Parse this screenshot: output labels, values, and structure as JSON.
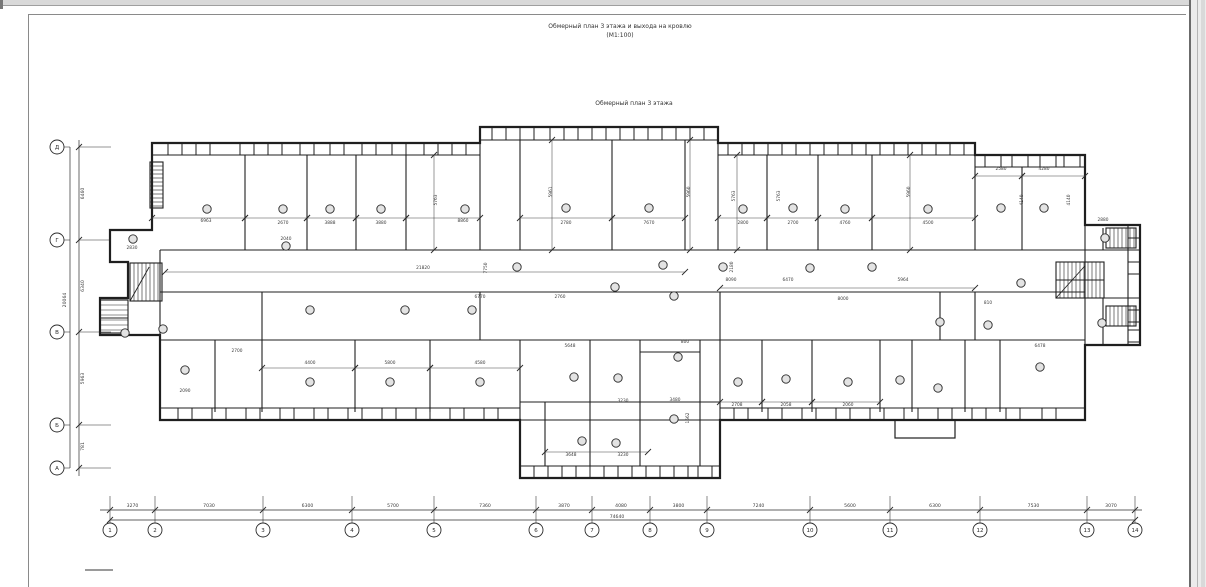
{
  "window": {
    "title_line1": "Обмерный план 3 этажа и выхода на кровлю",
    "title_line2": "(М1:100)",
    "subtitle": "Обмерный план 3 этажа"
  },
  "colors": {
    "ink": "#1f1f1f",
    "thin": "#333333",
    "dim_text": "#3a3a3a",
    "axis": "#2b2b2b"
  },
  "axes_bottom": {
    "y_chain": 510,
    "y_total": 520,
    "y_circle": 530,
    "r": 7,
    "line_x1": 100,
    "line_x2": 1142,
    "total": "74640",
    "total_x": 617,
    "nodes": [
      {
        "n": "1",
        "x": 110
      },
      {
        "n": "2",
        "x": 155
      },
      {
        "n": "3",
        "x": 263
      },
      {
        "n": "4",
        "x": 352
      },
      {
        "n": "5",
        "x": 434
      },
      {
        "n": "6",
        "x": 536
      },
      {
        "n": "7",
        "x": 592
      },
      {
        "n": "8",
        "x": 650
      },
      {
        "n": "9",
        "x": 707
      },
      {
        "n": "10",
        "x": 810
      },
      {
        "n": "11",
        "x": 890
      },
      {
        "n": "12",
        "x": 980
      },
      {
        "n": "13",
        "x": 1087
      },
      {
        "n": "14",
        "x": 1135
      }
    ],
    "spans": [
      "3270",
      "7030",
      "6300",
      "5700",
      "7360",
      "3870",
      "4080",
      "3800",
      "7240",
      "5600",
      "6300",
      "7530",
      "3070"
    ]
  },
  "axes_left": {
    "x_chain": 79,
    "x_total": 70,
    "x_circle": 57,
    "r": 7,
    "line_y1": 140,
    "line_y2": 476,
    "total": "20064",
    "total_y": 300,
    "nodes": [
      {
        "n": "Д",
        "y": 147
      },
      {
        "n": "Г",
        "y": 240
      },
      {
        "n": "В",
        "y": 332
      },
      {
        "n": "Б",
        "y": 425
      },
      {
        "n": "А",
        "y": 468
      }
    ],
    "spans": [
      "6460",
      "6340",
      "5963",
      "781"
    ]
  },
  "plan": {
    "outline": "152,143 480,143 480,127 718,127 718,143 975,143 975,155 1085,155 1085,225 1140,225 1140,345 1085,345 1085,420 720,420 720,478 520,478 520,420 160,420 160,335 100,335 100,298 128,298 128,262 110,262 110,230 152,230",
    "bands": [
      {
        "o": "h",
        "e1": 143,
        "e2": 155,
        "a1": 152,
        "a2": 480,
        "wins": [
          [
            168,
            14
          ],
          [
            196,
            14
          ],
          [
            240,
            14
          ],
          [
            268,
            14
          ],
          [
            300,
            14
          ],
          [
            330,
            14
          ],
          [
            362,
            14
          ],
          [
            392,
            14
          ],
          [
            424,
            14
          ],
          [
            452,
            14
          ]
        ]
      },
      {
        "o": "h",
        "e1": 127,
        "e2": 140,
        "a1": 480,
        "a2": 718,
        "wins": [
          [
            492,
            14
          ],
          [
            520,
            14
          ],
          [
            550,
            14
          ],
          [
            578,
            14
          ],
          [
            606,
            14
          ],
          [
            634,
            14
          ],
          [
            662,
            14
          ],
          [
            690,
            14
          ]
        ]
      },
      {
        "o": "h",
        "e1": 143,
        "e2": 155,
        "a1": 718,
        "a2": 975,
        "wins": [
          [
            728,
            14
          ],
          [
            754,
            14
          ],
          [
            782,
            14
          ],
          [
            810,
            14
          ],
          [
            838,
            14
          ],
          [
            866,
            14
          ],
          [
            894,
            14
          ],
          [
            922,
            14
          ],
          [
            950,
            14
          ]
        ]
      },
      {
        "o": "h",
        "e1": 155,
        "e2": 167,
        "a1": 975,
        "a2": 1085,
        "wins": [
          [
            985,
            16
          ],
          [
            1012,
            16
          ],
          [
            1040,
            16
          ],
          [
            1064,
            16
          ]
        ]
      },
      {
        "o": "h",
        "e1": 420,
        "e2": 408,
        "a1": 160,
        "a2": 520,
        "wins": [
          [
            178,
            14
          ],
          [
            212,
            14
          ],
          [
            246,
            14
          ],
          [
            280,
            14
          ],
          [
            314,
            14
          ],
          [
            348,
            14
          ],
          [
            382,
            14
          ],
          [
            416,
            14
          ],
          [
            450,
            14
          ],
          [
            484,
            14
          ]
        ]
      },
      {
        "o": "h",
        "e1": 478,
        "e2": 466,
        "a1": 520,
        "a2": 720,
        "wins": [
          [
            534,
            14
          ],
          [
            562,
            14
          ],
          [
            590,
            14
          ],
          [
            618,
            14
          ],
          [
            646,
            14
          ],
          [
            674,
            14
          ],
          [
            698,
            14
          ]
        ]
      },
      {
        "o": "h",
        "e1": 420,
        "e2": 408,
        "a1": 720,
        "a2": 1085,
        "wins": [
          [
            734,
            14
          ],
          [
            768,
            14
          ],
          [
            802,
            14
          ],
          [
            836,
            14
          ],
          [
            870,
            14
          ],
          [
            904,
            14
          ],
          [
            938,
            14
          ],
          [
            972,
            14
          ],
          [
            1006,
            14
          ],
          [
            1042,
            14
          ]
        ]
      },
      {
        "o": "v",
        "e1": 1140,
        "e2": 1128,
        "a1": 225,
        "a2": 345,
        "wins": [
          [
            238,
            12
          ],
          [
            262,
            12
          ],
          [
            310,
            12
          ],
          [
            330,
            12
          ]
        ]
      }
    ],
    "walls": [
      [
        160,
        250,
        1085,
        250
      ],
      [
        160,
        292,
        1085,
        292
      ],
      [
        160,
        340,
        1085,
        340
      ],
      [
        520,
        402,
        720,
        402
      ],
      [
        520,
        420,
        720,
        420
      ],
      [
        1085,
        250,
        1140,
        250
      ],
      [
        1085,
        298,
        1140,
        298
      ],
      [
        1056,
        280,
        1104,
        280
      ],
      [
        640,
        352,
        700,
        352
      ],
      [
        100,
        318,
        128,
        318
      ],
      [
        245,
        155,
        245,
        250
      ],
      [
        307,
        155,
        307,
        250
      ],
      [
        356,
        155,
        356,
        250
      ],
      [
        406,
        155,
        406,
        250
      ],
      [
        480,
        143,
        480,
        250
      ],
      [
        520,
        140,
        520,
        250
      ],
      [
        612,
        140,
        612,
        250
      ],
      [
        685,
        140,
        685,
        250
      ],
      [
        718,
        143,
        718,
        250
      ],
      [
        767,
        155,
        767,
        250
      ],
      [
        818,
        155,
        818,
        250
      ],
      [
        872,
        155,
        872,
        250
      ],
      [
        975,
        155,
        975,
        250
      ],
      [
        1022,
        167,
        1022,
        250
      ],
      [
        160,
        250,
        160,
        335
      ],
      [
        262,
        292,
        262,
        340
      ],
      [
        480,
        292,
        480,
        340
      ],
      [
        720,
        292,
        720,
        340
      ],
      [
        940,
        292,
        940,
        340
      ],
      [
        975,
        292,
        975,
        340
      ],
      [
        215,
        340,
        215,
        412
      ],
      [
        262,
        340,
        262,
        412
      ],
      [
        355,
        340,
        355,
        412
      ],
      [
        430,
        340,
        430,
        412
      ],
      [
        520,
        340,
        520,
        420
      ],
      [
        590,
        340,
        590,
        466
      ],
      [
        640,
        340,
        640,
        466
      ],
      [
        700,
        340,
        700,
        466
      ],
      [
        545,
        402,
        545,
        466
      ],
      [
        720,
        340,
        720,
        420
      ],
      [
        762,
        340,
        762,
        412
      ],
      [
        812,
        340,
        812,
        412
      ],
      [
        880,
        340,
        880,
        412
      ],
      [
        912,
        340,
        912,
        412
      ],
      [
        965,
        340,
        965,
        412
      ],
      [
        1000,
        340,
        1000,
        412
      ],
      [
        1103,
        228,
        1103,
        250
      ],
      [
        1103,
        298,
        1103,
        345
      ],
      [
        1085,
        225,
        1085,
        345
      ]
    ],
    "wallrects": [
      [
        895,
        420,
        60,
        18
      ]
    ],
    "dimlines": [
      [
        152,
        218,
        245,
        218
      ],
      [
        245,
        218,
        307,
        218
      ],
      [
        307,
        218,
        356,
        218
      ],
      [
        356,
        218,
        406,
        218
      ],
      [
        406,
        218,
        480,
        218
      ],
      [
        520,
        218,
        612,
        218
      ],
      [
        612,
        218,
        685,
        218
      ],
      [
        718,
        218,
        767,
        218
      ],
      [
        767,
        218,
        818,
        218
      ],
      [
        818,
        218,
        872,
        218
      ],
      [
        872,
        218,
        975,
        218
      ],
      [
        975,
        176,
        1022,
        176
      ],
      [
        1022,
        176,
        1085,
        176
      ],
      [
        434,
        155,
        434,
        250
      ],
      [
        552,
        140,
        552,
        250
      ],
      [
        690,
        140,
        690,
        250
      ],
      [
        737,
        155,
        737,
        250
      ],
      [
        910,
        155,
        910,
        250
      ],
      [
        165,
        272,
        685,
        272
      ],
      [
        720,
        288,
        975,
        288
      ],
      [
        262,
        368,
        355,
        368
      ],
      [
        355,
        368,
        430,
        368
      ],
      [
        430,
        368,
        520,
        368
      ],
      [
        545,
        452,
        648,
        452
      ],
      [
        720,
        402,
        762,
        402
      ],
      [
        762,
        402,
        812,
        402
      ],
      [
        812,
        402,
        880,
        402
      ]
    ],
    "stairs": [
      {
        "x": 130,
        "y": 263,
        "w": 32,
        "h": 38,
        "o": "v",
        "s": 4,
        "d": 1
      },
      {
        "x": 1056,
        "y": 262,
        "w": 48,
        "h": 36,
        "o": "v",
        "s": 4,
        "d": 1
      },
      {
        "x": 150,
        "y": 162,
        "w": 13,
        "h": 46,
        "o": "h",
        "s": 4,
        "d": 0
      },
      {
        "x": 100,
        "y": 300,
        "w": 28,
        "h": 33,
        "o": "h",
        "s": 5,
        "d": 0
      },
      {
        "x": 1106,
        "y": 228,
        "w": 30,
        "h": 20,
        "o": "v",
        "s": 4,
        "d": 0
      },
      {
        "x": 1106,
        "y": 306,
        "w": 30,
        "h": 20,
        "o": "v",
        "s": 4,
        "d": 0
      }
    ],
    "rooms": [
      [
        207,
        209
      ],
      [
        283,
        209
      ],
      [
        330,
        209
      ],
      [
        381,
        209
      ],
      [
        465,
        209
      ],
      [
        566,
        208
      ],
      [
        649,
        208
      ],
      [
        743,
        209
      ],
      [
        793,
        208
      ],
      [
        845,
        209
      ],
      [
        928,
        209
      ],
      [
        1001,
        208
      ],
      [
        1044,
        208
      ],
      [
        133,
        239
      ],
      [
        286,
        246
      ],
      [
        517,
        267
      ],
      [
        615,
        287
      ],
      [
        663,
        265
      ],
      [
        674,
        296
      ],
      [
        723,
        267
      ],
      [
        810,
        268
      ],
      [
        872,
        267
      ],
      [
        310,
        310
      ],
      [
        405,
        310
      ],
      [
        472,
        310
      ],
      [
        940,
        322
      ],
      [
        988,
        325
      ],
      [
        1021,
        283
      ],
      [
        1105,
        238
      ],
      [
        1102,
        323
      ],
      [
        125,
        333
      ],
      [
        163,
        329
      ],
      [
        185,
        370
      ],
      [
        310,
        382
      ],
      [
        390,
        382
      ],
      [
        480,
        382
      ],
      [
        574,
        377
      ],
      [
        618,
        378
      ],
      [
        678,
        357
      ],
      [
        582,
        441
      ],
      [
        616,
        443
      ],
      [
        674,
        419
      ],
      [
        738,
        382
      ],
      [
        786,
        379
      ],
      [
        848,
        382
      ],
      [
        900,
        380
      ],
      [
        938,
        388
      ],
      [
        1040,
        367
      ]
    ],
    "dims": [
      [
        "6963",
        206,
        222,
        0
      ],
      [
        "2670",
        283,
        224,
        0
      ],
      [
        "3888",
        330,
        224,
        0
      ],
      [
        "3880",
        381,
        224,
        0
      ],
      [
        "8860",
        463,
        222,
        0
      ],
      [
        "2780",
        566,
        224,
        0
      ],
      [
        "7670",
        649,
        224,
        0
      ],
      [
        "2800",
        743,
        224,
        0
      ],
      [
        "2700",
        793,
        224,
        0
      ],
      [
        "4760",
        845,
        224,
        0
      ],
      [
        "4500",
        928,
        224,
        0
      ],
      [
        "2580",
        1001,
        170,
        0
      ],
      [
        "4280",
        1044,
        170,
        0
      ],
      [
        "5763",
        437,
        200,
        1
      ],
      [
        "5961",
        552,
        192,
        1
      ],
      [
        "5960",
        690,
        192,
        1
      ],
      [
        "5763",
        735,
        196,
        1
      ],
      [
        "5763",
        780,
        196,
        1
      ],
      [
        "5960",
        910,
        192,
        1
      ],
      [
        "4140",
        1023,
        200,
        1
      ],
      [
        "4140",
        1070,
        200,
        1
      ],
      [
        "2830",
        132,
        249,
        0
      ],
      [
        "2040",
        286,
        240,
        0
      ],
      [
        "21820",
        423,
        269,
        0
      ],
      [
        "7750",
        487,
        268,
        1
      ],
      [
        "6770",
        480,
        298,
        0
      ],
      [
        "2760",
        560,
        298,
        0
      ],
      [
        "2180",
        733,
        267,
        1
      ],
      [
        "8090",
        731,
        281,
        0
      ],
      [
        "6470",
        788,
        281,
        0
      ],
      [
        "5964",
        903,
        281,
        0
      ],
      [
        "8000",
        843,
        300,
        0
      ],
      [
        "5648",
        570,
        347,
        0
      ],
      [
        "800",
        685,
        343,
        0
      ],
      [
        "3230",
        623,
        402,
        0
      ],
      [
        "3480",
        675,
        401,
        0
      ],
      [
        "3648",
        571,
        456,
        0
      ],
      [
        "3230",
        623,
        456,
        0
      ],
      [
        "1562",
        689,
        418,
        1
      ],
      [
        "810",
        988,
        304,
        0
      ],
      [
        "2880",
        1103,
        221,
        0
      ],
      [
        "4400",
        310,
        364,
        0
      ],
      [
        "5800",
        390,
        364,
        0
      ],
      [
        "4580",
        480,
        364,
        0
      ],
      [
        "2708",
        737,
        406,
        0
      ],
      [
        "2058",
        786,
        406,
        0
      ],
      [
        "2060",
        848,
        406,
        0
      ],
      [
        "6478",
        1040,
        347,
        0
      ],
      [
        "2090",
        185,
        392,
        0
      ],
      [
        "2700",
        237,
        352,
        0
      ]
    ]
  }
}
